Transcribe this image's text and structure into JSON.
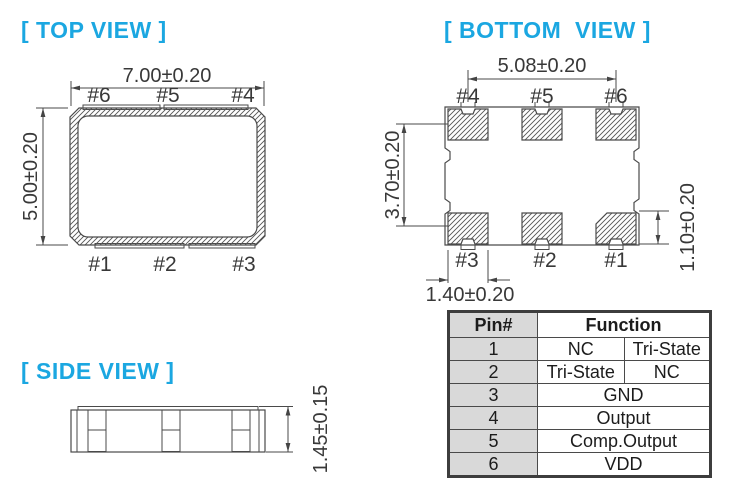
{
  "colors": {
    "title_accent": "#1BA7E1",
    "drawing_line": "#4a4a4a",
    "table_pin_column_bg": "#d9d9d9"
  },
  "top_view": {
    "title": "[ TOP VIEW ]",
    "dim_width": "7.00±0.20",
    "dim_height": "5.00±0.20",
    "pins_top": [
      "#6",
      "#5",
      "#4"
    ],
    "pins_bottom": [
      "#1",
      "#2",
      "#3"
    ]
  },
  "bottom_view": {
    "title": "[ BOTTOM  VIEW ]",
    "dim_pad_span": "5.08±0.20",
    "dim_row_span": "3.70±0.20",
    "dim_pad_height": "1.10±0.20",
    "dim_pad_width": "1.40±0.20",
    "pins_top": [
      "#4",
      "#5",
      "#6"
    ],
    "pins_bottom": [
      "#3",
      "#2",
      "#1"
    ]
  },
  "side_view": {
    "title": "[ SIDE VIEW ]",
    "dim_height": "1.45±0.15"
  },
  "pin_table": {
    "header_pin": "Pin#",
    "header_function": "Function",
    "rows": [
      {
        "pin": "1",
        "cells": [
          "NC",
          "Tri-State"
        ]
      },
      {
        "pin": "2",
        "cells": [
          "Tri-State",
          "NC"
        ]
      },
      {
        "pin": "3",
        "cells": [
          "GND"
        ]
      },
      {
        "pin": "4",
        "cells": [
          "Output"
        ]
      },
      {
        "pin": "5",
        "cells": [
          "Comp.Output"
        ]
      },
      {
        "pin": "6",
        "cells": [
          "VDD"
        ]
      }
    ]
  }
}
